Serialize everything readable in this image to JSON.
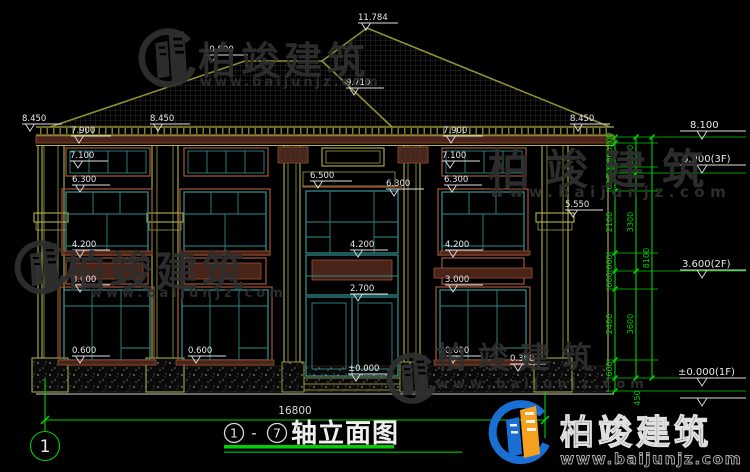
{
  "drawing": {
    "title": "轴立面图",
    "axis_start": "1",
    "axis_end": "7",
    "title_separator": "-",
    "axis_bubble": "1",
    "total_width": "16800"
  },
  "levels": [
    "8.450",
    "10.800",
    "11.784",
    "9.710",
    "8.450",
    "8.450",
    "7.900",
    "7.900",
    "7.100",
    "7.100",
    "6.300",
    "6.500",
    "6.300",
    "6.300",
    "5.550",
    "4.200",
    "4.200",
    "4.200",
    "3.000",
    "3.000",
    "2.700",
    "0.600",
    "0.600",
    "0.600",
    "0.300",
    "±0.000"
  ],
  "right_levels": [
    "8.100",
    "6.900(3F)",
    "3.600(2F)",
    "±0.000(1F)"
  ],
  "dim_chain_inner": [
    "200",
    "800",
    "200",
    "600",
    "2100",
    "600",
    "600",
    "2400",
    "600",
    "450"
  ],
  "dim_chain_middle": [
    "1200",
    "3300",
    "3600"
  ],
  "dim_chain_outer": [
    "8100"
  ],
  "watermark": {
    "brand": "柏竣建筑",
    "site": "www.baijunjz.com"
  },
  "logo": {
    "brand": "柏竣建筑",
    "site": "www.baijunjz.com"
  },
  "colors": {
    "background": "#000000",
    "dim_green": "#00d000",
    "window_teal": "#2e8b8b",
    "trim_brown": "#9b4f35",
    "band_olive": "#b4b44a",
    "roof_olive": "#8f8f35",
    "dim_text": "#e8e8e8",
    "watermark_gray": "#2f2f2f",
    "logo_blue": "#1a6fd4",
    "logo_orange": "#f5a01e"
  }
}
